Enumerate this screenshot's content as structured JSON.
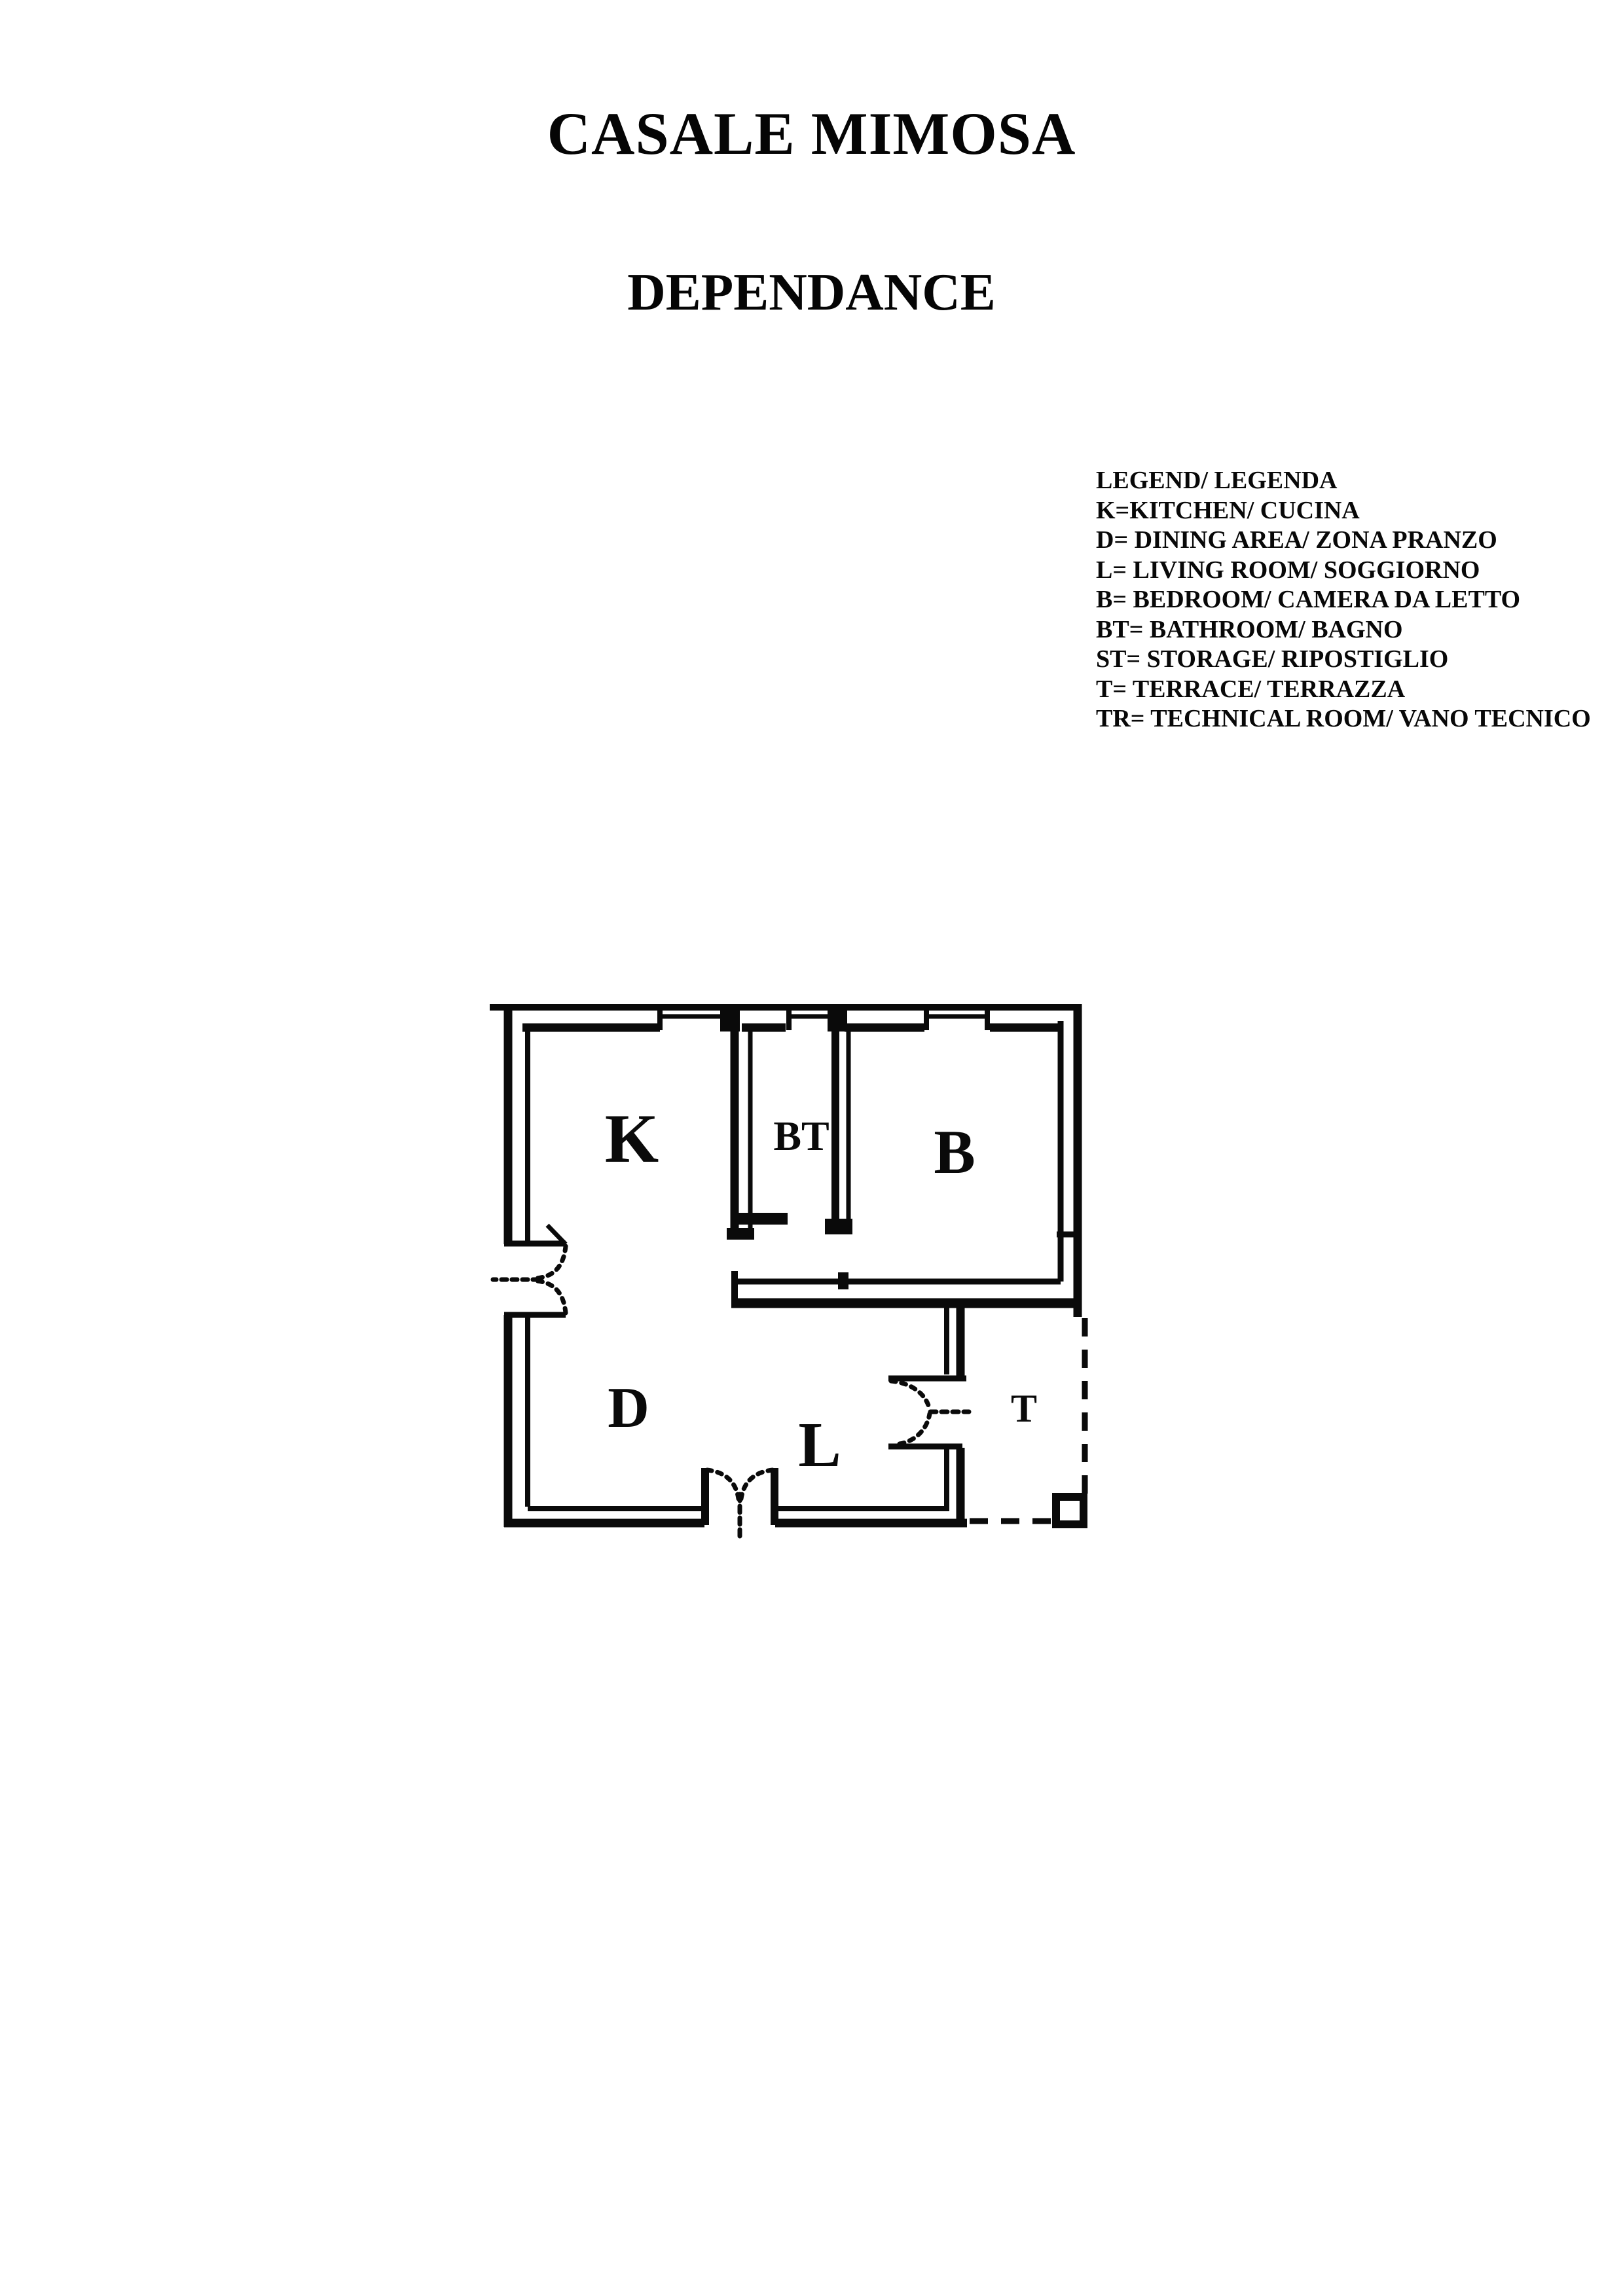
{
  "page": {
    "title": "CASALE MIMOSA",
    "subtitle": "DEPENDANCE",
    "paper_color": "#ffffff",
    "ink_color": "#0a0a0a"
  },
  "legend": {
    "items": [
      "LEGEND/ LEGENDA",
      "K=KITCHEN/ CUCINA",
      "D= DINING AREA/ ZONA PRANZO",
      "L= LIVING ROOM/ SOGGIORNO",
      "B= BEDROOM/ CAMERA DA LETTO",
      "BT= BATHROOM/ BAGNO",
      "ST= STORAGE/ RIPOSTIGLIO",
      "T= TERRACE/ TERRAZZA",
      "TR= TECHNICAL ROOM/ VANO TECNICO"
    ]
  },
  "plan": {
    "rooms": {
      "kitchen": "K",
      "bathroom": "BT",
      "bedroom": "B",
      "dining": "D",
      "living": "L",
      "terrace": "T"
    }
  }
}
